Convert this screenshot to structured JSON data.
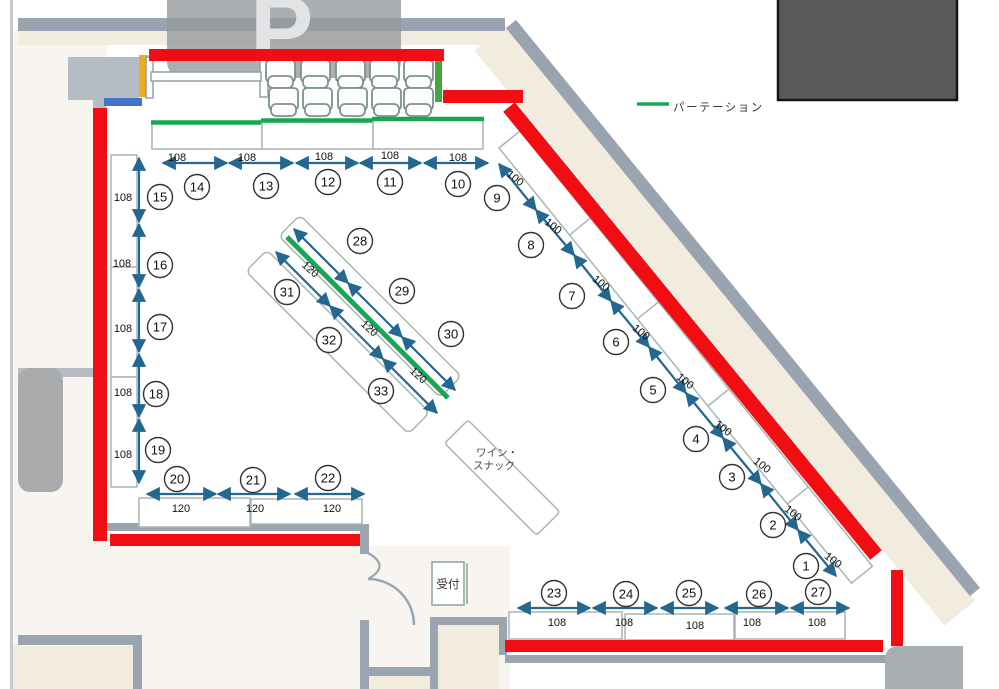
{
  "legend": {
    "label": "パーテーション"
  },
  "labels": {
    "parking": "P",
    "reception": "受付",
    "wine_snack_line1": "ワイン・",
    "wine_snack_line2": "スナック"
  },
  "colors": {
    "wall_red": "#f20d12",
    "partition_green": "#16a752",
    "dimension_blue": "#24678f",
    "band_beige": "#f2ecdf",
    "band_gray": "#9aa4b0",
    "floor_pale": "#f8f5f1",
    "shelf_outline": "#a7b6b2",
    "dark_panel": "#58595b",
    "furniture_gray": "#b4bcc4",
    "accent_yellow": "#f2aa1d",
    "accent_blue": "#4472c4",
    "accent_green_bar": "#48a43f",
    "building_gray": "#a8aaac",
    "inner_wall_gray": "#9aa5af"
  },
  "stations": [
    {
      "n": "1",
      "x": 806,
      "y": 566
    },
    {
      "n": "2",
      "x": 773,
      "y": 525
    },
    {
      "n": "3",
      "x": 732,
      "y": 477
    },
    {
      "n": "4",
      "x": 696,
      "y": 439
    },
    {
      "n": "5",
      "x": 653,
      "y": 390
    },
    {
      "n": "6",
      "x": 616,
      "y": 342
    },
    {
      "n": "7",
      "x": 572,
      "y": 296
    },
    {
      "n": "8",
      "x": 531,
      "y": 245
    },
    {
      "n": "9",
      "x": 497,
      "y": 198
    },
    {
      "n": "10",
      "x": 458,
      "y": 184
    },
    {
      "n": "11",
      "x": 390,
      "y": 182
    },
    {
      "n": "12",
      "x": 328,
      "y": 182
    },
    {
      "n": "13",
      "x": 266,
      "y": 186
    },
    {
      "n": "14",
      "x": 197,
      "y": 187
    },
    {
      "n": "15",
      "x": 160,
      "y": 197
    },
    {
      "n": "16",
      "x": 160,
      "y": 265
    },
    {
      "n": "17",
      "x": 160,
      "y": 327
    },
    {
      "n": "18",
      "x": 156,
      "y": 394
    },
    {
      "n": "19",
      "x": 158,
      "y": 450
    },
    {
      "n": "20",
      "x": 177,
      "y": 479
    },
    {
      "n": "21",
      "x": 253,
      "y": 480
    },
    {
      "n": "22",
      "x": 328,
      "y": 478
    },
    {
      "n": "23",
      "x": 554,
      "y": 593
    },
    {
      "n": "24",
      "x": 626,
      "y": 594
    },
    {
      "n": "25",
      "x": 689,
      "y": 593
    },
    {
      "n": "26",
      "x": 759,
      "y": 594
    },
    {
      "n": "27",
      "x": 818,
      "y": 592
    },
    {
      "n": "28",
      "x": 360,
      "y": 241
    },
    {
      "n": "29",
      "x": 402,
      "y": 291
    },
    {
      "n": "30",
      "x": 451,
      "y": 334
    },
    {
      "n": "31",
      "x": 287,
      "y": 292
    },
    {
      "n": "32",
      "x": 329,
      "y": 340
    },
    {
      "n": "33",
      "x": 381,
      "y": 391
    }
  ],
  "dimensions": [
    {
      "t": "108",
      "x": 177,
      "y": 161,
      "r": 0
    },
    {
      "t": "108",
      "x": 247,
      "y": 161,
      "r": 0
    },
    {
      "t": "108",
      "x": 324,
      "y": 160,
      "r": 0
    },
    {
      "t": "108",
      "x": 390,
      "y": 159,
      "r": 0
    },
    {
      "t": "108",
      "x": 458,
      "y": 161,
      "r": 0
    },
    {
      "t": "108",
      "x": 123,
      "y": 201,
      "r": 0
    },
    {
      "t": "108",
      "x": 122,
      "y": 267,
      "r": 0
    },
    {
      "t": "108",
      "x": 123,
      "y": 332,
      "r": 0
    },
    {
      "t": "108",
      "x": 123,
      "y": 396,
      "r": 0
    },
    {
      "t": "108",
      "x": 123,
      "y": 458,
      "r": 0
    },
    {
      "t": "120",
      "x": 181,
      "y": 512,
      "r": 0
    },
    {
      "t": "120",
      "x": 255,
      "y": 512,
      "r": 0
    },
    {
      "t": "120",
      "x": 332,
      "y": 512,
      "r": 0
    },
    {
      "t": "108",
      "x": 557,
      "y": 626,
      "r": 0
    },
    {
      "t": "108",
      "x": 624,
      "y": 626,
      "r": 0
    },
    {
      "t": "108",
      "x": 695,
      "y": 629,
      "r": 0
    },
    {
      "t": "108",
      "x": 752,
      "y": 626,
      "r": 0
    },
    {
      "t": "108",
      "x": 817,
      "y": 626,
      "r": 0
    },
    {
      "t": "100",
      "x": 513,
      "y": 181,
      "r": 38
    },
    {
      "t": "100",
      "x": 551,
      "y": 229,
      "r": 38
    },
    {
      "t": "100",
      "x": 599,
      "y": 286,
      "r": 38
    },
    {
      "t": "100",
      "x": 639,
      "y": 335,
      "r": 38
    },
    {
      "t": "100",
      "x": 683,
      "y": 384,
      "r": 38
    },
    {
      "t": "100",
      "x": 721,
      "y": 431,
      "r": 38
    },
    {
      "t": "100",
      "x": 760,
      "y": 468,
      "r": 38
    },
    {
      "t": "100",
      "x": 791,
      "y": 516,
      "r": 38
    },
    {
      "t": "100",
      "x": 831,
      "y": 563,
      "r": 38
    },
    {
      "t": "120",
      "x": 308,
      "y": 272,
      "r": 42
    },
    {
      "t": "120",
      "x": 367,
      "y": 331,
      "r": 42
    },
    {
      "t": "120",
      "x": 416,
      "y": 378,
      "r": 42
    }
  ],
  "arrows": [
    [
      163,
      163,
      227,
      163
    ],
    [
      229,
      163,
      293,
      163
    ],
    [
      296,
      163,
      358,
      163
    ],
    [
      360,
      163,
      421,
      163
    ],
    [
      424,
      163,
      488,
      163
    ],
    [
      139,
      158,
      139,
      222
    ],
    [
      139,
      224,
      139,
      287
    ],
    [
      139,
      289,
      139,
      352
    ],
    [
      139,
      354,
      139,
      417
    ],
    [
      139,
      419,
      139,
      483
    ],
    [
      147,
      494,
      216,
      494
    ],
    [
      218,
      494,
      290,
      494
    ],
    [
      295,
      494,
      364,
      494
    ],
    [
      518,
      608,
      590,
      608
    ],
    [
      593,
      608,
      657,
      608
    ],
    [
      661,
      608,
      718,
      608
    ],
    [
      725,
      608,
      788,
      608
    ],
    [
      791,
      608,
      849,
      608
    ],
    [
      499,
      164,
      536,
      210
    ],
    [
      536,
      210,
      574,
      255
    ],
    [
      574,
      255,
      611,
      301
    ],
    [
      611,
      301,
      649,
      347
    ],
    [
      649,
      347,
      686,
      393
    ],
    [
      686,
      393,
      723,
      438
    ],
    [
      723,
      438,
      761,
      484
    ],
    [
      761,
      484,
      798,
      530
    ],
    [
      798,
      530,
      836,
      576
    ],
    [
      294,
      229,
      348,
      283
    ],
    [
      348,
      283,
      402,
      337
    ],
    [
      402,
      337,
      455,
      390
    ],
    [
      276,
      252,
      330,
      306
    ],
    [
      330,
      306,
      383,
      359
    ],
    [
      383,
      359,
      437,
      413
    ]
  ]
}
